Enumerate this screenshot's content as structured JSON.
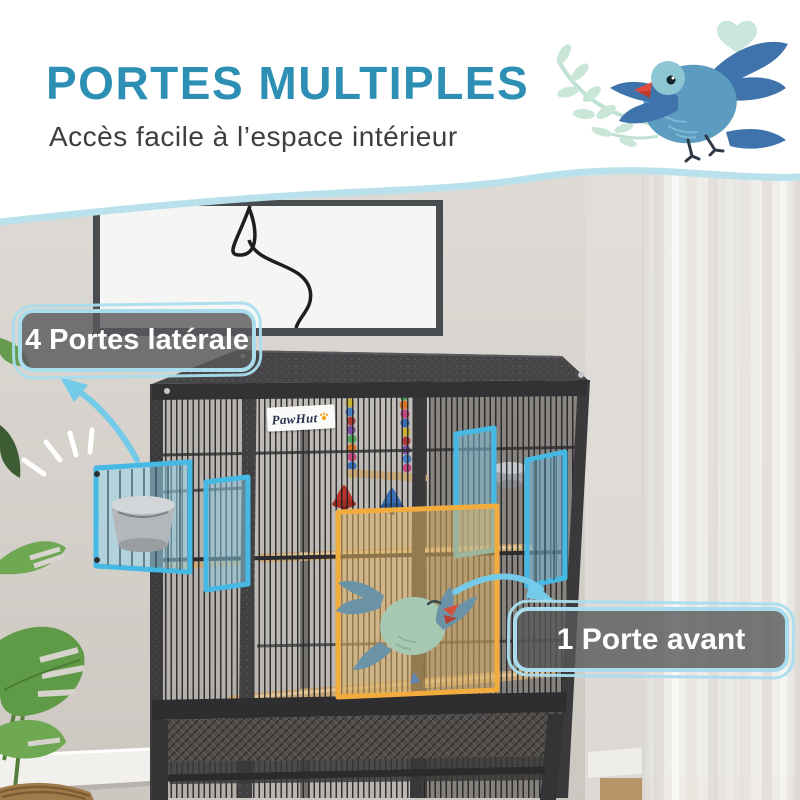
{
  "header": {
    "title": "PORTES MULTIPLES",
    "subtitle": "Accès facile à l’espace intérieur"
  },
  "callouts": {
    "side_doors": {
      "label": "4 Portes latérale"
    },
    "front_door": {
      "label": "1 Porte avant"
    }
  },
  "product": {
    "brand_label": "PawHut"
  },
  "illustration": {
    "top_right": "blue-bird-with-leaf-branch-and-heart",
    "in_cage": "sleeping-green-bird-cartoon"
  },
  "colors": {
    "title_text": "#2E8FB5",
    "subtitle_text": "#3E3E40",
    "highlight_blue": "#45B9E3",
    "highlight_orange": "#F2AC3E",
    "callout_border": "#A9DDEE",
    "callout_background": "rgba(88,88,90,0.8)",
    "arrow_blue": "#74CBE9",
    "wave_edge": "#B9E1EC"
  }
}
